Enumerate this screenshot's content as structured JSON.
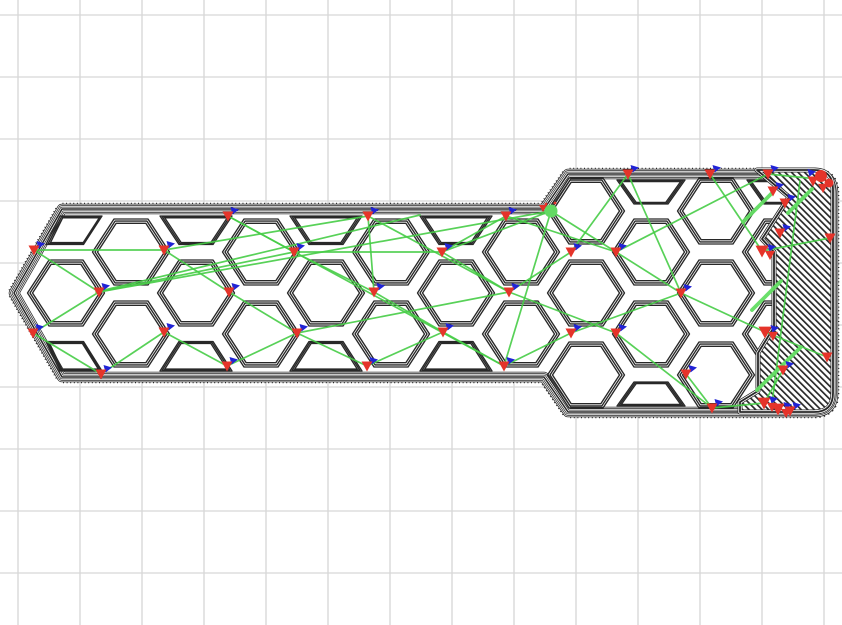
{
  "canvas": {
    "width": 842,
    "height": 625,
    "background": "#ffffff"
  },
  "grid": {
    "offset_x": 18,
    "offset_y": 15,
    "step": 62,
    "color": "#d6d6d6",
    "line_width": 1.3
  },
  "colors": {
    "wall": "#282828",
    "white": "#ffffff",
    "travel": "#47cd47",
    "travel_bright": "#63de63",
    "retract": "#e5342a",
    "deretract": "#2023d6",
    "tool_dot": "#63d963"
  },
  "outline": {
    "path": "M 14,293 L 62,209 L 544,209 L 568,174 L 814,174 Q 833,174 833,193 L 833,393 Q 833,412 814,412 L 568,412 L 544,377 L 62,377 Z",
    "band_widths": [
      10.5,
      9,
      7.5,
      6,
      4.5,
      3,
      1.5
    ],
    "stipple_width": 12.6,
    "stipple_dash": [
      1,
      2.6
    ]
  },
  "cell_style": {
    "nest_factors": [
      1,
      0.935,
      0.87
    ],
    "stroke_width": 1.35
  },
  "shapes": {
    "hex": [
      [
        -38.5,
        0
      ],
      [
        -17,
        -33
      ],
      [
        17,
        -33
      ],
      [
        38.5,
        0
      ],
      [
        17,
        33
      ],
      [
        -17,
        33
      ]
    ],
    "trapT": [
      [
        -36,
        -14
      ],
      [
        36,
        -14
      ],
      [
        17,
        14.5
      ],
      [
        -17,
        14.5
      ]
    ],
    "trapB": [
      [
        -17,
        -14.5
      ],
      [
        17,
        -14.5
      ],
      [
        36,
        15
      ],
      [
        -36,
        15
      ]
    ],
    "trapTh": [
      [
        -34,
        -12
      ],
      [
        34,
        -12
      ],
      [
        17,
        12
      ],
      [
        -17,
        12
      ]
    ],
    "trapBh": [
      [
        -17,
        -12
      ],
      [
        17,
        -12
      ],
      [
        34,
        12
      ],
      [
        -34,
        12
      ]
    ],
    "pent0T": [
      [
        -21,
        -14
      ],
      [
        21,
        -14
      ],
      [
        2.5,
        14.5
      ],
      [
        -35,
        14.5
      ]
    ],
    "pent0B": [
      [
        -28,
        -14.5
      ],
      [
        9.5,
        -14.5
      ],
      [
        28,
        15
      ],
      [
        -14,
        15
      ]
    ]
  },
  "cells": [
    {
      "kind": "pent0T",
      "x": 81,
      "y": 230
    },
    {
      "kind": "hex",
      "x": 66,
      "y": 293
    },
    {
      "kind": "pent0B",
      "x": 74,
      "y": 356
    },
    {
      "kind": "hex",
      "x": 131,
      "y": 252
    },
    {
      "kind": "hex",
      "x": 131,
      "y": 334
    },
    {
      "kind": "trapT",
      "x": 196,
      "y": 230
    },
    {
      "kind": "hex",
      "x": 196,
      "y": 293
    },
    {
      "kind": "trapB",
      "x": 196,
      "y": 356
    },
    {
      "kind": "hex",
      "x": 261,
      "y": 252
    },
    {
      "kind": "hex",
      "x": 261,
      "y": 334
    },
    {
      "kind": "trapT",
      "x": 326,
      "y": 230
    },
    {
      "kind": "hex",
      "x": 326,
      "y": 293
    },
    {
      "kind": "trapB",
      "x": 326,
      "y": 356
    },
    {
      "kind": "hex",
      "x": 391,
      "y": 252
    },
    {
      "kind": "hex",
      "x": 391,
      "y": 334
    },
    {
      "kind": "trapT",
      "x": 456,
      "y": 230
    },
    {
      "kind": "hex",
      "x": 456,
      "y": 293
    },
    {
      "kind": "trapB",
      "x": 456,
      "y": 356
    },
    {
      "kind": "hex",
      "x": 521,
      "y": 252
    },
    {
      "kind": "hex",
      "x": 521,
      "y": 334
    },
    {
      "kind": "hex",
      "x": 586,
      "y": 211
    },
    {
      "kind": "hex",
      "x": 586,
      "y": 293
    },
    {
      "kind": "hex",
      "x": 586,
      "y": 375
    },
    {
      "kind": "trapTh",
      "x": 651,
      "y": 192
    },
    {
      "kind": "hex",
      "x": 651,
      "y": 252
    },
    {
      "kind": "hex",
      "x": 651,
      "y": 334
    },
    {
      "kind": "trapBh",
      "x": 651,
      "y": 394
    },
    {
      "kind": "hex",
      "x": 716,
      "y": 211
    },
    {
      "kind": "hex",
      "x": 716,
      "y": 293
    },
    {
      "kind": "hex",
      "x": 716,
      "y": 375
    },
    {
      "kind": "trapTh",
      "x": 781,
      "y": 192
    },
    {
      "kind": "hex",
      "x": 781,
      "y": 252
    },
    {
      "kind": "hex",
      "x": 781,
      "y": 334
    },
    {
      "kind": "trapBh",
      "x": 781,
      "y": 394
    }
  ],
  "hatch": {
    "path": "M 757,170 L 814,170 Q 833,170 833,189 L 833,393 Q 833,412 814,412 L 740,412 L 740,402 L 758,391 L 758,353 L 774,327 L 774,252 L 762,239 L 789,197 Z",
    "stripe_period": 4.6,
    "stripe_width": 1.7,
    "angle": -45,
    "border_widths": [
      5,
      3.4,
      1.8
    ]
  },
  "travels": [
    [
      34,
      250,
      164,
      250
    ],
    [
      34,
      250,
      99,
      292
    ],
    [
      99,
      292,
      33,
      333
    ],
    [
      33,
      333,
      101,
      374
    ],
    [
      101,
      374,
      164,
      332
    ],
    [
      99,
      292,
      294,
      252
    ],
    [
      99,
      292,
      551,
      211
    ],
    [
      96,
      292,
      420,
      215
    ],
    [
      164,
      250,
      229,
      292
    ],
    [
      164,
      332,
      227,
      366
    ],
    [
      164,
      250,
      368,
      216
    ],
    [
      228,
      216,
      294,
      252
    ],
    [
      229,
      292,
      297,
      333
    ],
    [
      227,
      366,
      297,
      333
    ],
    [
      228,
      216,
      504,
      366
    ],
    [
      294,
      252,
      374,
      292
    ],
    [
      297,
      333,
      367,
      366
    ],
    [
      294,
      252,
      442,
      252
    ],
    [
      297,
      333,
      509,
      292
    ],
    [
      368,
      216,
      374,
      292
    ],
    [
      368,
      216,
      509,
      292
    ],
    [
      374,
      292,
      443,
      332
    ],
    [
      367,
      366,
      443,
      332
    ],
    [
      442,
      252,
      506,
      216
    ],
    [
      442,
      252,
      509,
      292
    ],
    [
      443,
      332,
      504,
      366
    ],
    [
      442,
      252,
      551,
      211
    ],
    [
      506,
      216,
      616,
      252
    ],
    [
      509,
      292,
      571,
      252
    ],
    [
      504,
      366,
      571,
      333
    ],
    [
      509,
      292,
      616,
      333
    ],
    [
      551,
      211,
      616,
      252
    ],
    [
      551,
      211,
      504,
      366
    ],
    [
      571,
      252,
      628,
      174
    ],
    [
      571,
      333,
      681,
      293
    ],
    [
      616,
      252,
      768,
      174
    ],
    [
      628,
      174,
      681,
      293
    ],
    [
      616,
      333,
      712,
      408
    ],
    [
      616,
      252,
      681,
      293
    ],
    [
      681,
      293,
      765,
      332
    ],
    [
      686,
      374,
      712,
      408
    ],
    [
      710,
      174,
      762,
      251
    ],
    [
      768,
      174,
      818,
      179
    ],
    [
      762,
      251,
      830,
      238
    ],
    [
      765,
      332,
      827,
      357
    ],
    [
      783,
      370,
      764,
      403
    ],
    [
      712,
      408,
      764,
      403
    ],
    [
      800,
      181,
      772,
      404
    ]
  ],
  "thick_travels": [
    [
      743,
      222,
      772,
      193
    ],
    [
      752,
      310,
      781,
      281
    ],
    [
      757,
      390,
      801,
      347
    ],
    [
      788,
      213,
      812,
      189
    ]
  ],
  "markers": [
    {
      "x": 34,
      "y": 250,
      "kind": "pair"
    },
    {
      "x": 99,
      "y": 292,
      "kind": "pair"
    },
    {
      "x": 33,
      "y": 333,
      "kind": "pair"
    },
    {
      "x": 101,
      "y": 374,
      "kind": "pair"
    },
    {
      "x": 164,
      "y": 250,
      "kind": "pair"
    },
    {
      "x": 164,
      "y": 332,
      "kind": "pair"
    },
    {
      "x": 228,
      "y": 216,
      "kind": "pair"
    },
    {
      "x": 229,
      "y": 292,
      "kind": "pair"
    },
    {
      "x": 227,
      "y": 366,
      "kind": "pair"
    },
    {
      "x": 294,
      "y": 252,
      "kind": "pair"
    },
    {
      "x": 297,
      "y": 333,
      "kind": "pair"
    },
    {
      "x": 368,
      "y": 216,
      "kind": "pair"
    },
    {
      "x": 374,
      "y": 292,
      "kind": "pair"
    },
    {
      "x": 367,
      "y": 366,
      "kind": "pair"
    },
    {
      "x": 442,
      "y": 252,
      "kind": "pair"
    },
    {
      "x": 443,
      "y": 332,
      "kind": "pair"
    },
    {
      "x": 506,
      "y": 216,
      "kind": "pair"
    },
    {
      "x": 509,
      "y": 292,
      "kind": "pair"
    },
    {
      "x": 504,
      "y": 366,
      "kind": "pair"
    },
    {
      "x": 571,
      "y": 252,
      "kind": "pair"
    },
    {
      "x": 571,
      "y": 333,
      "kind": "pair"
    },
    {
      "x": 628,
      "y": 174,
      "kind": "pair"
    },
    {
      "x": 710,
      "y": 174,
      "kind": "pair"
    },
    {
      "x": 768,
      "y": 174,
      "kind": "pair"
    },
    {
      "x": 616,
      "y": 252,
      "kind": "pair"
    },
    {
      "x": 616,
      "y": 333,
      "kind": "pair"
    },
    {
      "x": 681,
      "y": 293,
      "kind": "pair"
    },
    {
      "x": 686,
      "y": 374,
      "kind": "pair"
    },
    {
      "x": 773,
      "y": 191,
      "kind": "pair"
    },
    {
      "x": 785,
      "y": 203,
      "kind": "pair"
    },
    {
      "x": 780,
      "y": 233,
      "kind": "pair"
    },
    {
      "x": 762,
      "y": 251,
      "kind": "red2"
    },
    {
      "x": 765,
      "y": 332,
      "kind": "red2"
    },
    {
      "x": 783,
      "y": 370,
      "kind": "pair"
    },
    {
      "x": 830,
      "y": 238,
      "kind": "red"
    },
    {
      "x": 827,
      "y": 357,
      "kind": "red"
    },
    {
      "x": 712,
      "y": 408,
      "kind": "pair"
    },
    {
      "x": 764,
      "y": 403,
      "kind": "red2"
    },
    {
      "x": 778,
      "y": 409,
      "kind": "red2"
    },
    {
      "x": 790,
      "y": 411,
      "kind": "pair"
    },
    {
      "x": 821,
      "y": 180,
      "kind": "blob"
    }
  ],
  "tool_marker": {
    "x": 551,
    "y": 211,
    "r": 6.5,
    "speck_triangle": [
      543,
      208
    ],
    "specks": [
      [
        546,
        204
      ],
      [
        555,
        203
      ]
    ]
  }
}
